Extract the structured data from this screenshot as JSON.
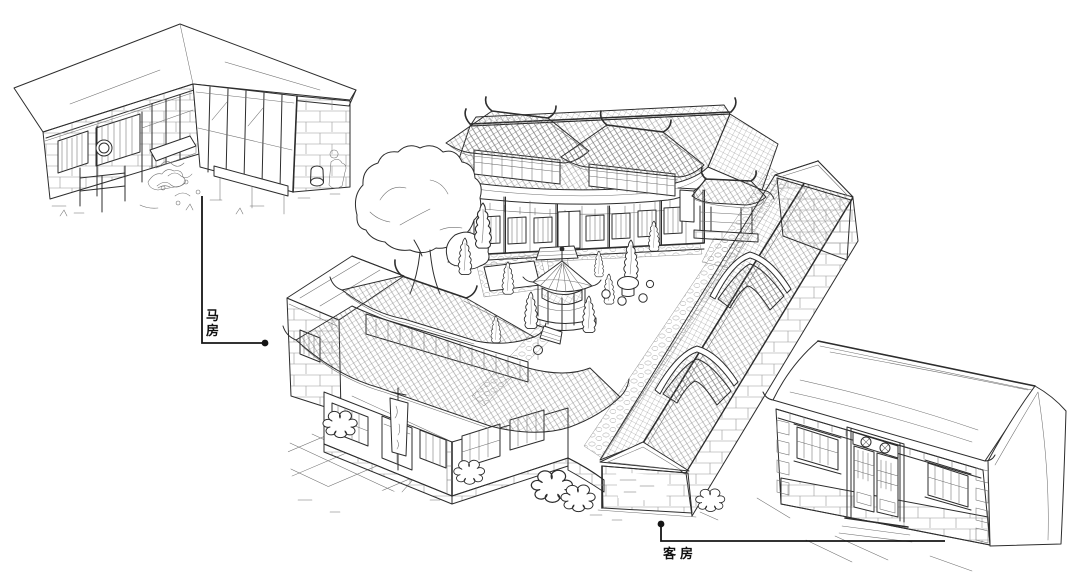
{
  "canvas": {
    "paper": "#ffffff",
    "ink": "#2d2d2d",
    "leader": "#151515"
  },
  "annotations": {
    "stable": {
      "label": "马房"
    },
    "guesthouse": {
      "label": "客房"
    }
  }
}
